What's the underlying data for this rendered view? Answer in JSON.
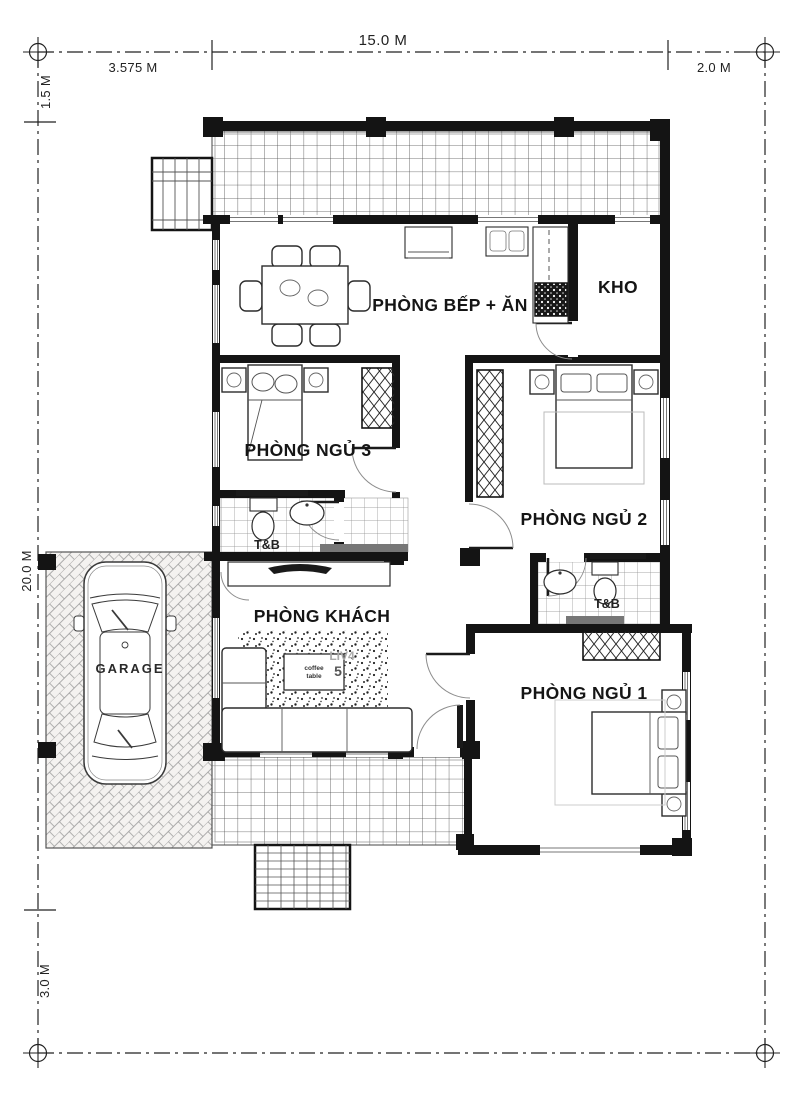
{
  "plan": {
    "title": "single-storey house floor plan",
    "dimensions": {
      "top_total": "15.0 M",
      "top_left_segment": "3.575 M",
      "top_right_segment": "2.0 M",
      "side_top": "1.5 M",
      "side_main": "20.0 M",
      "side_bottom": "3.0 M"
    },
    "rooms": {
      "kitchen_dining": "PHÒNG BẾP + ĂN",
      "storage": "KHO",
      "bedroom3": "PHÒNG NGỦ 3",
      "bedroom2": "PHÒNG NGỦ 2",
      "bedroom1": "PHÒNG NGỦ 1",
      "living": "PHÒNG KHÁCH",
      "bath_bedroom3": "T&B",
      "bath_bedroom2": "T&B",
      "garage": "GARAGE"
    },
    "annotations": {
      "coffee_table_line1": "coffee",
      "coffee_table_line2": "table",
      "watermark": "LIV4",
      "watermark_number": "5"
    },
    "colors": {
      "wall": "#141414",
      "line": "#333333",
      "tile_line": "#8a8a8a",
      "background": "#ffffff"
    }
  }
}
